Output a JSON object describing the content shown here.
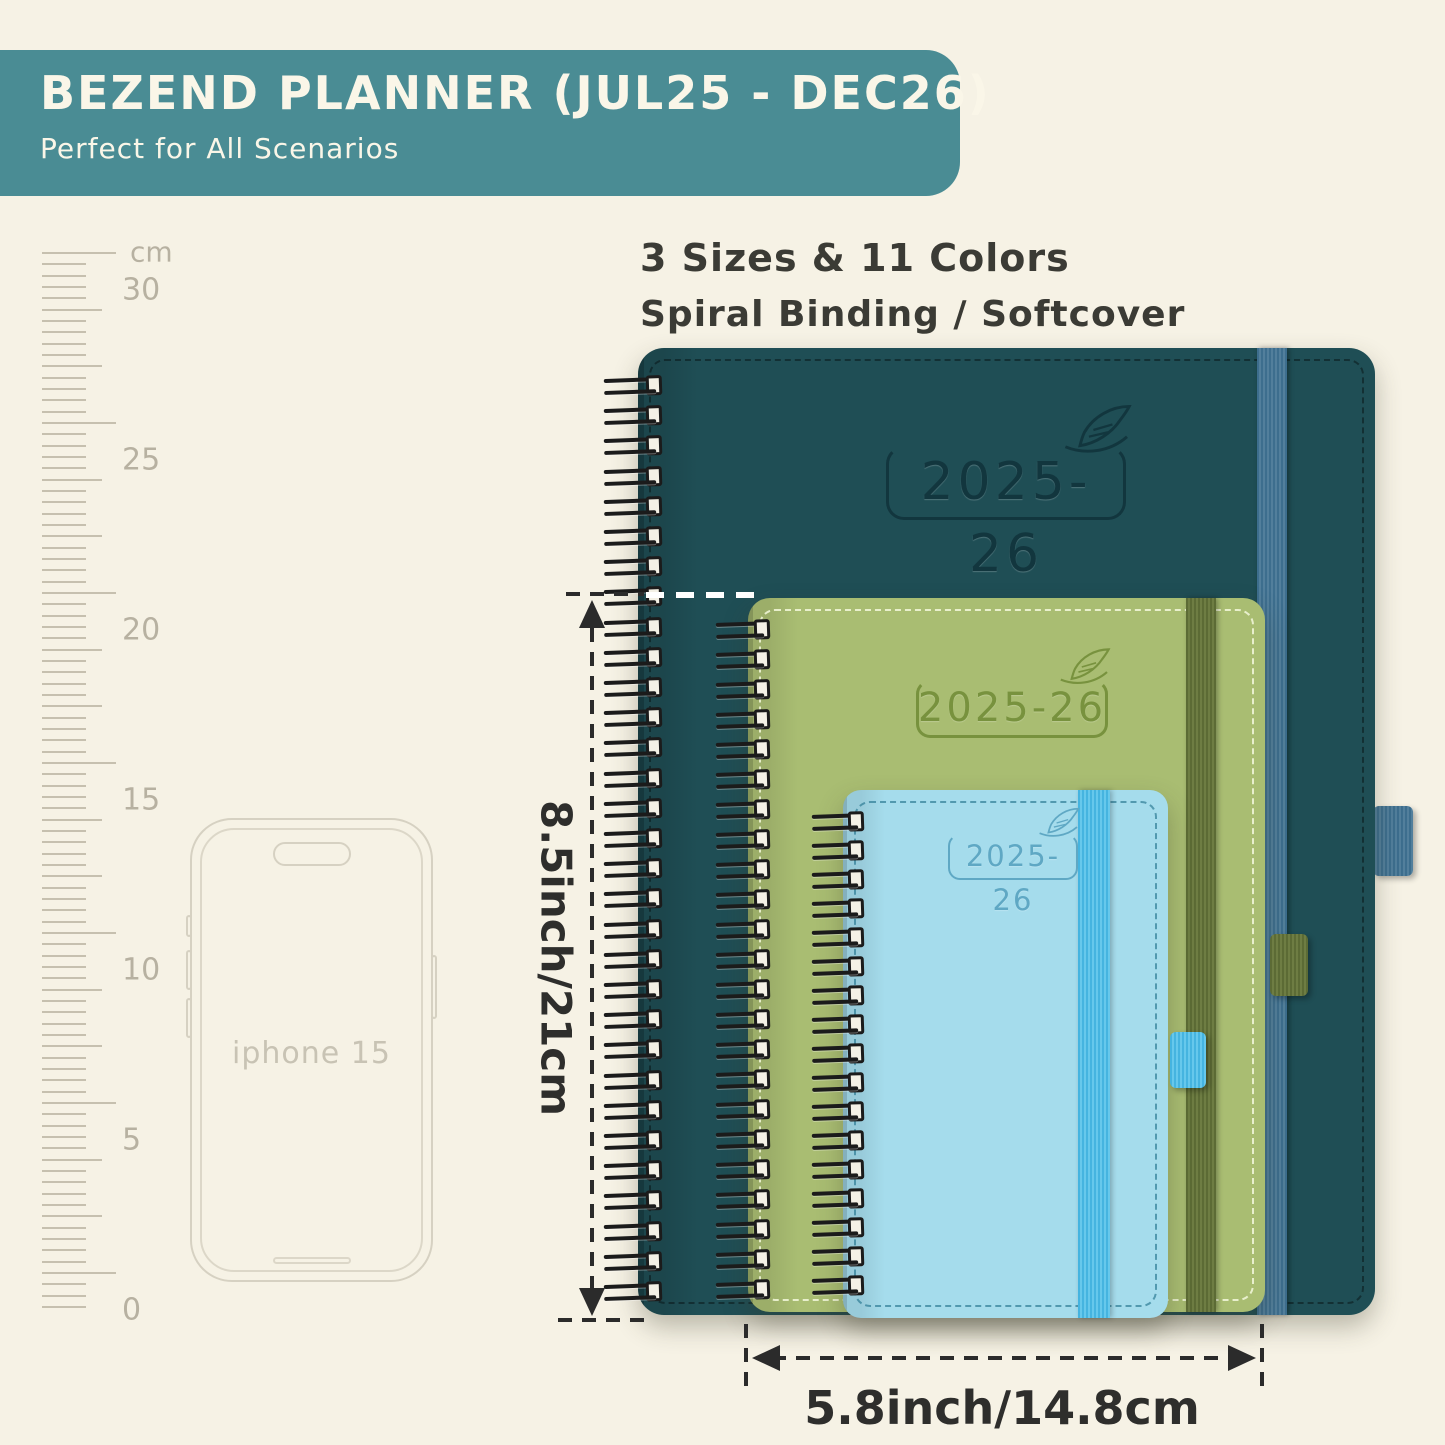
{
  "banner": {
    "title": "BEZEND PLANNER (JUL25 - DEC26)",
    "subtitle": "Perfect for All Scenarios"
  },
  "headline": {
    "line1": "3 Sizes & 11 Colors",
    "line2": "Spiral Binding / Softcover"
  },
  "ruler": {
    "unit": "cm",
    "marks": [
      "30",
      "25",
      "20",
      "15",
      "10",
      "5",
      "0"
    ]
  },
  "phone": {
    "label": "iphone 15"
  },
  "planners": {
    "large": {
      "year": "2025-26",
      "cover_color": "#1f4e55",
      "band_color": "#3d6e8e"
    },
    "medium": {
      "year": "2025-26",
      "cover_color": "#a9bd72",
      "band_color": "#5c6b35"
    },
    "small": {
      "year": "2025-26",
      "cover_color": "#a5dcec",
      "band_color": "#45b4e0"
    }
  },
  "dimensions": {
    "height": "8.5inch/21cm",
    "width": "5.8inch/14.8cm"
  },
  "colors": {
    "background": "#f6f2e5",
    "banner": "#4a8c94",
    "banner_text": "#faf6e8",
    "headline_text": "#3b3b35",
    "ruler_marks": "#c6c0af",
    "dimension_lines": "#2b2b2b"
  }
}
